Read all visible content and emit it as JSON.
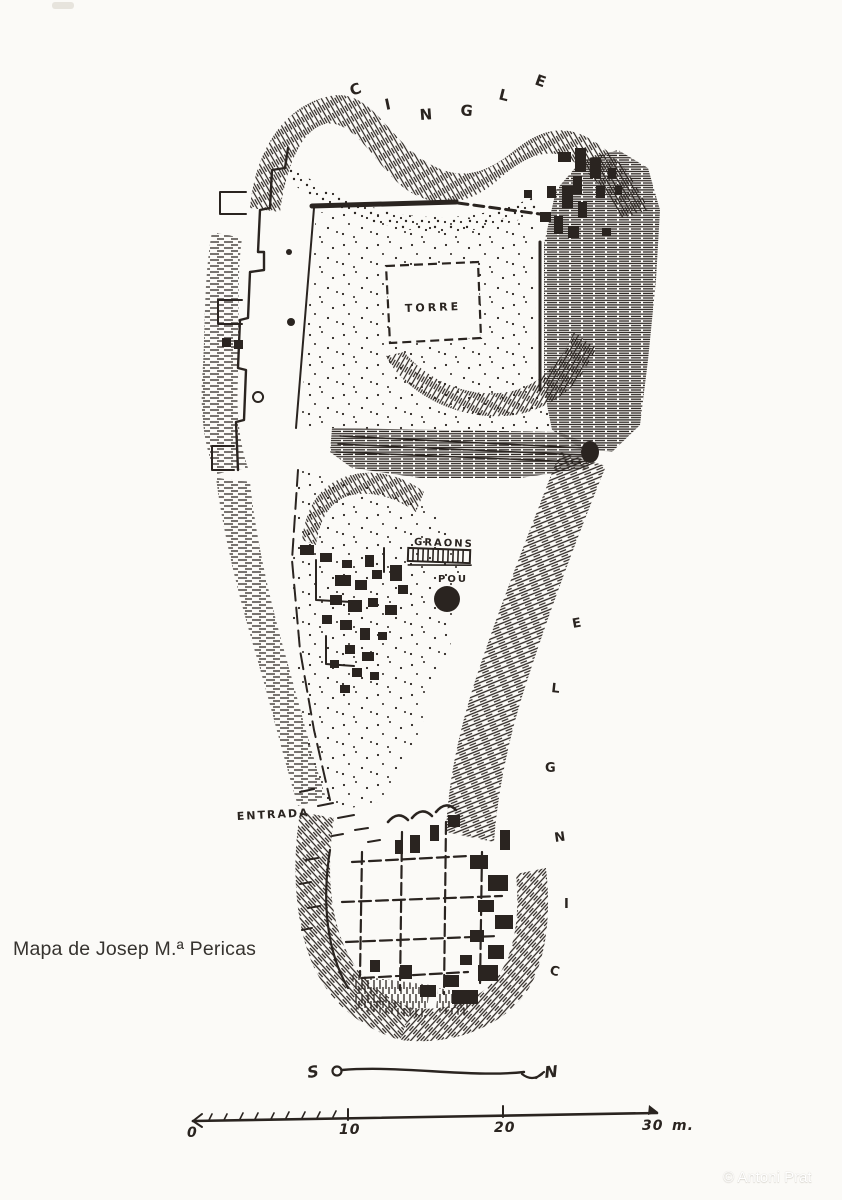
{
  "page": {
    "caption": "Mapa de Josep M.ª Pericas",
    "copyright": "© Antoni Prat"
  },
  "map": {
    "kind": "hand-drawn archaeological site plan",
    "labels": {
      "cingle_top": {
        "text": "CINGLE",
        "letters": [
          "C",
          "I",
          "N",
          "G",
          "L",
          "E"
        ]
      },
      "cingle_right": {
        "text": "CINGLE",
        "letters_top_to_bottom": [
          "E",
          "L",
          "G",
          "N",
          "I",
          "C"
        ]
      },
      "torre": "TORRE",
      "graons": "GRAONS",
      "pou": "POU",
      "entrada": "ENTRADA"
    },
    "compass": {
      "south": "S",
      "north": "N"
    },
    "scale_bar": {
      "tick_labels": [
        "0",
        "10",
        "20",
        "30"
      ],
      "unit": "m.",
      "max_meters": 30
    },
    "colors": {
      "ink": "#2a2420",
      "paper": "#fbfaf7",
      "copyright_text": "#ffffff"
    }
  }
}
